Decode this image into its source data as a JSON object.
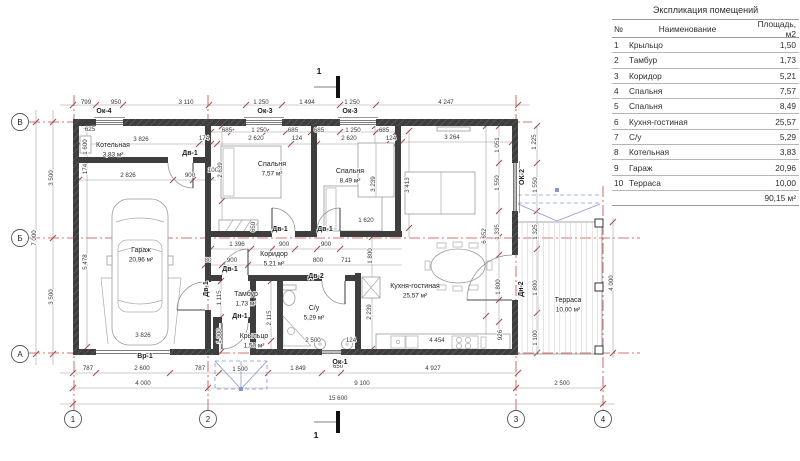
{
  "table": {
    "title": "Экспликация помещений",
    "headers": {
      "num": "№",
      "name": "Наименование",
      "area": "Площадь, м2"
    },
    "rows": [
      {
        "num": "1",
        "name": "Крыльцо",
        "area": "1,50"
      },
      {
        "num": "2",
        "name": "Тамбур",
        "area": "1,73"
      },
      {
        "num": "3",
        "name": "Коридор",
        "area": "5,21"
      },
      {
        "num": "4",
        "name": "Спальня",
        "area": "7,57"
      },
      {
        "num": "5",
        "name": "Спальня",
        "area": "8,49"
      },
      {
        "num": "6",
        "name": "Кухня-гостиная",
        "area": "25,57"
      },
      {
        "num": "7",
        "name": "С/у",
        "area": "5,29"
      },
      {
        "num": "8",
        "name": "Котельная",
        "area": "3,83"
      },
      {
        "num": "9",
        "name": "Гараж",
        "area": "20,96"
      },
      {
        "num": "10",
        "name": "Терраса",
        "area": "10,00"
      }
    ],
    "total": "90,15 м²"
  },
  "plan": {
    "rooms": [
      [
        "Котельная",
        "3,83 м²",
        113,
        147
      ],
      [
        "Гараж",
        "20,96 м²",
        141,
        252
      ],
      [
        "Спальня",
        "7,57 м²",
        272,
        166
      ],
      [
        "Спальня",
        "8,49 м²",
        350,
        173
      ],
      [
        "Кухня-гостиная",
        "25,57 м²",
        415,
        288
      ],
      [
        "Коридор",
        "5,21 м²",
        274,
        256
      ],
      [
        "Тамбур",
        "1,73 м²",
        246,
        296
      ],
      [
        "Крыльцо",
        "1,50 м²",
        254,
        338
      ],
      [
        "С/у",
        "5,29 м²",
        314,
        310
      ],
      [
        "Терраса",
        "10,00 м²",
        568,
        302
      ]
    ],
    "dims": [
      [
        "799",
        86,
        104
      ],
      [
        "950",
        116,
        104
      ],
      [
        "3 110",
        186,
        104
      ],
      [
        "1 250",
        261,
        104
      ],
      [
        "1 494",
        307,
        104
      ],
      [
        "1 250",
        352,
        104
      ],
      [
        "4 247",
        446,
        104
      ],
      [
        "625",
        90,
        131
      ],
      [
        "685",
        227,
        132
      ],
      [
        "1 250",
        259,
        132
      ],
      [
        "685",
        293,
        132
      ],
      [
        "685",
        319,
        132
      ],
      [
        "1 250",
        353,
        132
      ],
      [
        "685",
        384,
        132
      ],
      [
        "3 826",
        141,
        141
      ],
      [
        "174",
        204,
        140
      ],
      [
        "2 620",
        256,
        140
      ],
      [
        "124",
        297,
        140
      ],
      [
        "2 620",
        349,
        140
      ],
      [
        "124",
        391,
        140
      ],
      [
        "3 264",
        452,
        139
      ],
      [
        "3 500",
        53,
        178,
        1
      ],
      [
        "3 500",
        53,
        297,
        1
      ],
      [
        "7 000",
        36,
        238,
        1
      ],
      [
        "1 600",
        87,
        147,
        1
      ],
      [
        "174",
        87,
        169,
        1
      ],
      [
        "5 478",
        87,
        262,
        1
      ],
      [
        "2 826",
        128,
        177
      ],
      [
        "900",
        190,
        177
      ],
      [
        "100",
        213,
        172
      ],
      [
        "2 639",
        222,
        170,
        1
      ],
      [
        "650",
        255,
        227,
        1
      ],
      [
        "3 239",
        375,
        184,
        1
      ],
      [
        "3 413",
        409,
        185,
        1
      ],
      [
        "1 620",
        366,
        222
      ],
      [
        "1 396",
        237,
        246
      ],
      [
        "900",
        284,
        246
      ],
      [
        "900",
        326,
        246
      ],
      [
        "80",
        208,
        262
      ],
      [
        "900",
        232,
        262
      ],
      [
        "800",
        318,
        262
      ],
      [
        "711",
        346,
        262
      ],
      [
        "1 800",
        372,
        256,
        1
      ],
      [
        "1 115",
        221,
        298,
        1
      ],
      [
        "1 000",
        221,
        336,
        1
      ],
      [
        "2 115",
        271,
        318,
        1
      ],
      [
        "2 500",
        313,
        342
      ],
      [
        "124",
        351,
        342
      ],
      [
        "2 239",
        371,
        312,
        1
      ],
      [
        "6 652",
        486,
        236,
        1
      ],
      [
        "1 800",
        500,
        287,
        1
      ],
      [
        "926",
        502,
        335,
        1
      ],
      [
        "4 454",
        437,
        342
      ],
      [
        "1 051",
        499,
        145,
        1
      ],
      [
        "1 550",
        499,
        183,
        1
      ],
      [
        "1 335",
        499,
        232,
        1
      ],
      [
        "1 225",
        536,
        142,
        1
      ],
      [
        "1 550",
        537,
        185,
        1
      ],
      [
        "1 325",
        537,
        232,
        1
      ],
      [
        "1 800",
        537,
        288,
        1
      ],
      [
        "1 100",
        537,
        338,
        1
      ],
      [
        "4 000",
        613,
        283,
        1
      ],
      [
        "3 826",
        143,
        337
      ],
      [
        "787",
        88,
        370
      ],
      [
        "2 600",
        142,
        370
      ],
      [
        "787",
        200,
        370
      ],
      [
        "1 500",
        240,
        371
      ],
      [
        "1 849",
        298,
        370
      ],
      [
        "650",
        338,
        368
      ],
      [
        "4 927",
        433,
        370
      ],
      [
        "4 000",
        143,
        385
      ],
      [
        "9 100",
        362,
        385
      ],
      [
        "2 500",
        562,
        385
      ],
      [
        "15 600",
        338,
        400
      ]
    ],
    "openings": [
      [
        "Ок-4",
        104,
        113
      ],
      [
        "Ок-3",
        265,
        113
      ],
      [
        "Ок-3",
        350,
        113
      ],
      [
        "Ок-1",
        340,
        364
      ],
      [
        "ОК-2",
        524,
        177,
        1
      ],
      [
        "Дв-1",
        190,
        155
      ],
      [
        "Дв-1",
        208,
        289,
        1
      ],
      [
        "Дв-1",
        230,
        271
      ],
      [
        "Дв-1",
        280,
        231
      ],
      [
        "Дв-1",
        325,
        231
      ],
      [
        "Дв-2",
        316,
        278
      ],
      [
        "Дн-1",
        240,
        318
      ],
      [
        "Дн-2",
        523,
        289,
        1
      ],
      [
        "Вр-1",
        145,
        358
      ]
    ],
    "grid_cols": [
      [
        "1",
        73
      ],
      [
        "2",
        208
      ],
      [
        "3",
        516
      ],
      [
        "4",
        603
      ]
    ],
    "grid_rows": [
      [
        "В",
        122
      ],
      [
        "Б",
        238
      ],
      [
        "А",
        354
      ]
    ],
    "section_marks": [
      [
        "1",
        319,
        74
      ],
      [
        "1",
        316,
        438
      ]
    ]
  }
}
